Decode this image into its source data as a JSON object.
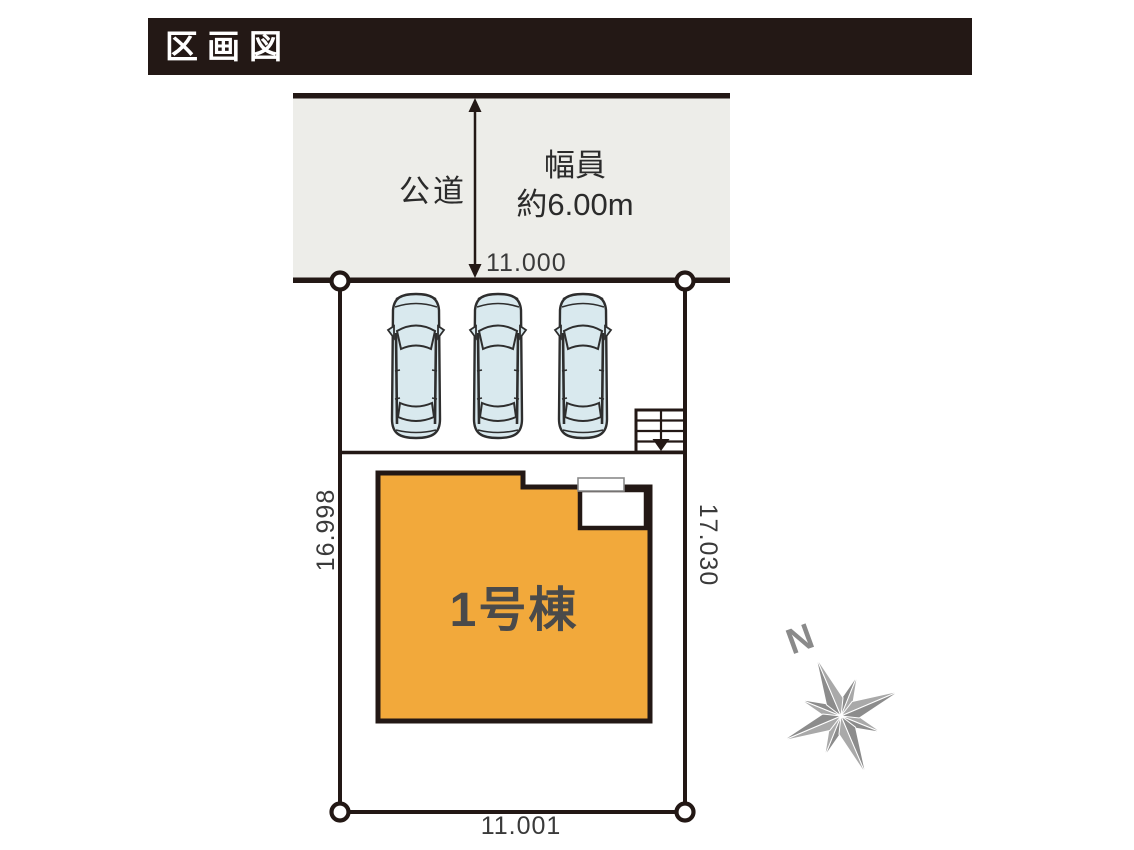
{
  "title": "区画図",
  "road": {
    "label": "公道",
    "width_line1": "幅員",
    "width_line2": "約6.00m"
  },
  "dimensions": {
    "top": "11.000",
    "left": "16.998",
    "right": "17.030",
    "bottom": "11.001"
  },
  "building": {
    "label": "1号棟"
  },
  "parking": {
    "car_count": 3
  },
  "stairs": {
    "present": true
  },
  "compass": {
    "north_label": "N"
  },
  "colors": {
    "banner_bg": "#231815",
    "banner_text": "#ffffff",
    "road_fill": "#edede9",
    "line": "#231815",
    "building_fill": "#f2a93b",
    "building_label_text": "#4a4a4a",
    "car_fill": "#d9e9ee",
    "compass_gray": "#8c8c8c",
    "compass_gray_light": "#a9a9a9"
  }
}
